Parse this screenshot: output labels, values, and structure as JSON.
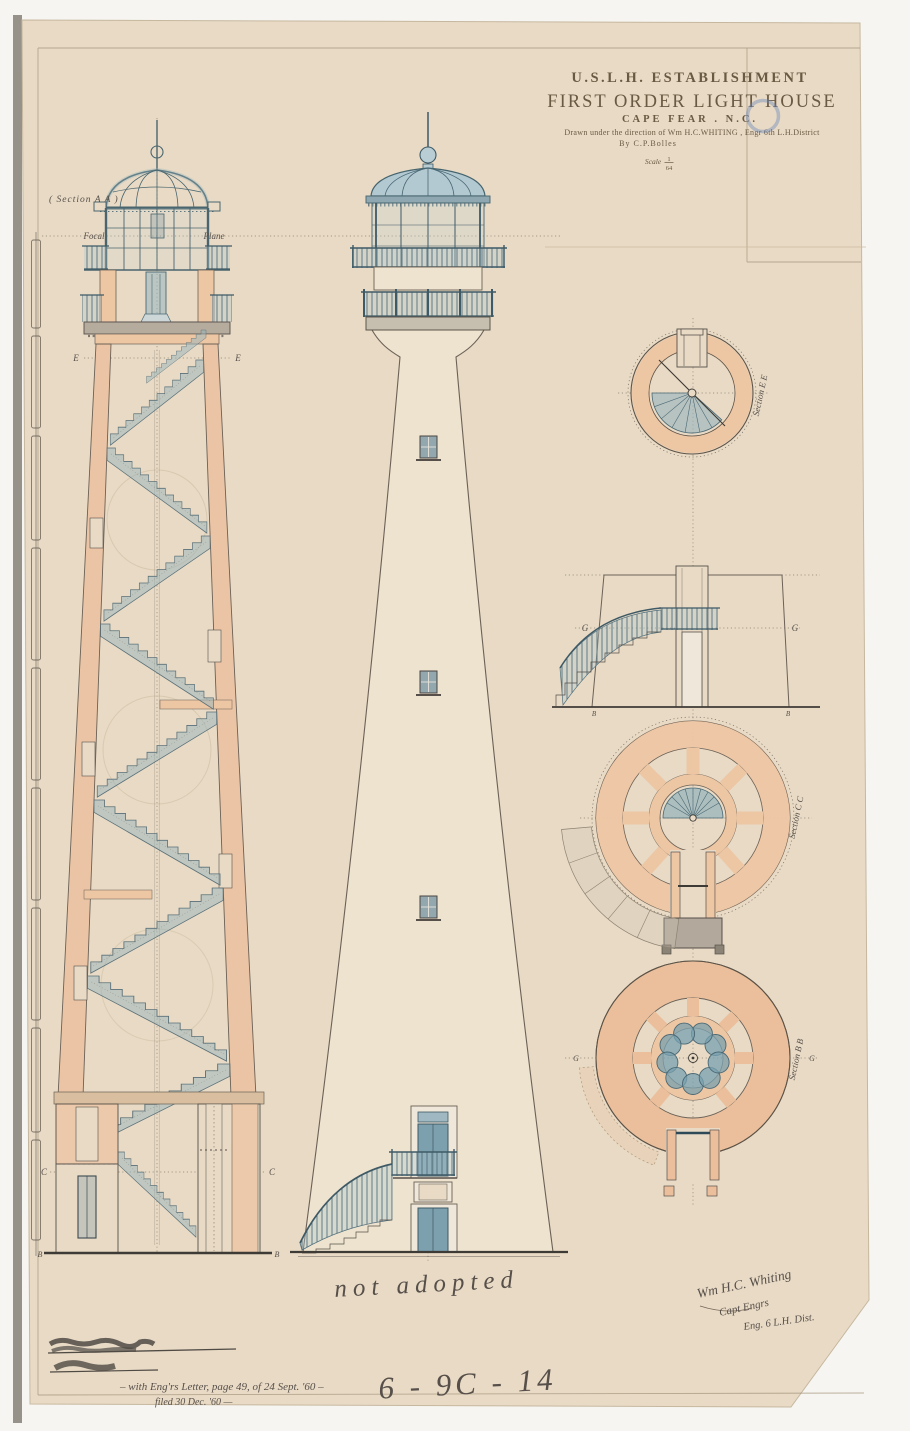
{
  "title_block": {
    "line1": "U.S.L.H. ESTABLISHMENT",
    "line2": "FIRST ORDER LIGHT HOUSE",
    "line3": "CAPE FEAR . N.C.",
    "credit": "Drawn under the direction of Wm H.C.WHITING , Engr 6th L.H.District",
    "by": "By C.P.Bolles",
    "scale_label": "Scale",
    "scale_numerator": "1",
    "scale_denominator": "64"
  },
  "section_labels": {
    "aa": "( Section A A )",
    "focal": "Focal",
    "plane": "Plane",
    "ee": "Section E E",
    "cc": "Section C C",
    "bb": "Section B B",
    "e_left": "E",
    "e_right": "E",
    "c_left": "C",
    "c_right": "C",
    "b_left": "B",
    "b_right": "B",
    "g_elev_left": "G",
    "g_elev_right": "G",
    "elev_corner_left": "B",
    "elev_corner_right": "B",
    "g_plan_left": "G",
    "g_plan_right": "G"
  },
  "annotations": {
    "not_adopted": "not adopted",
    "file_number": "6 - 9C - 14",
    "filing_note": "– with Eng'rs Letter, page 49, of 24 Sept. '60 –",
    "filed_note": "filed 30 Dec. '60 —",
    "signature_name": "Wm H.C. Whiting",
    "signature_rank": "Capt Engrs",
    "signature_dist": "Eng. 6 L.H. Dist."
  },
  "colors": {
    "paper": "#e8dac5",
    "masonry_salmon": "#edc6a4",
    "stair_blue": "#a9c4cc",
    "ironwork_blue": "#46606c",
    "ink": "#57504a",
    "pencil": "#b7a58c",
    "stamp_blue": "#7d9cc4"
  }
}
